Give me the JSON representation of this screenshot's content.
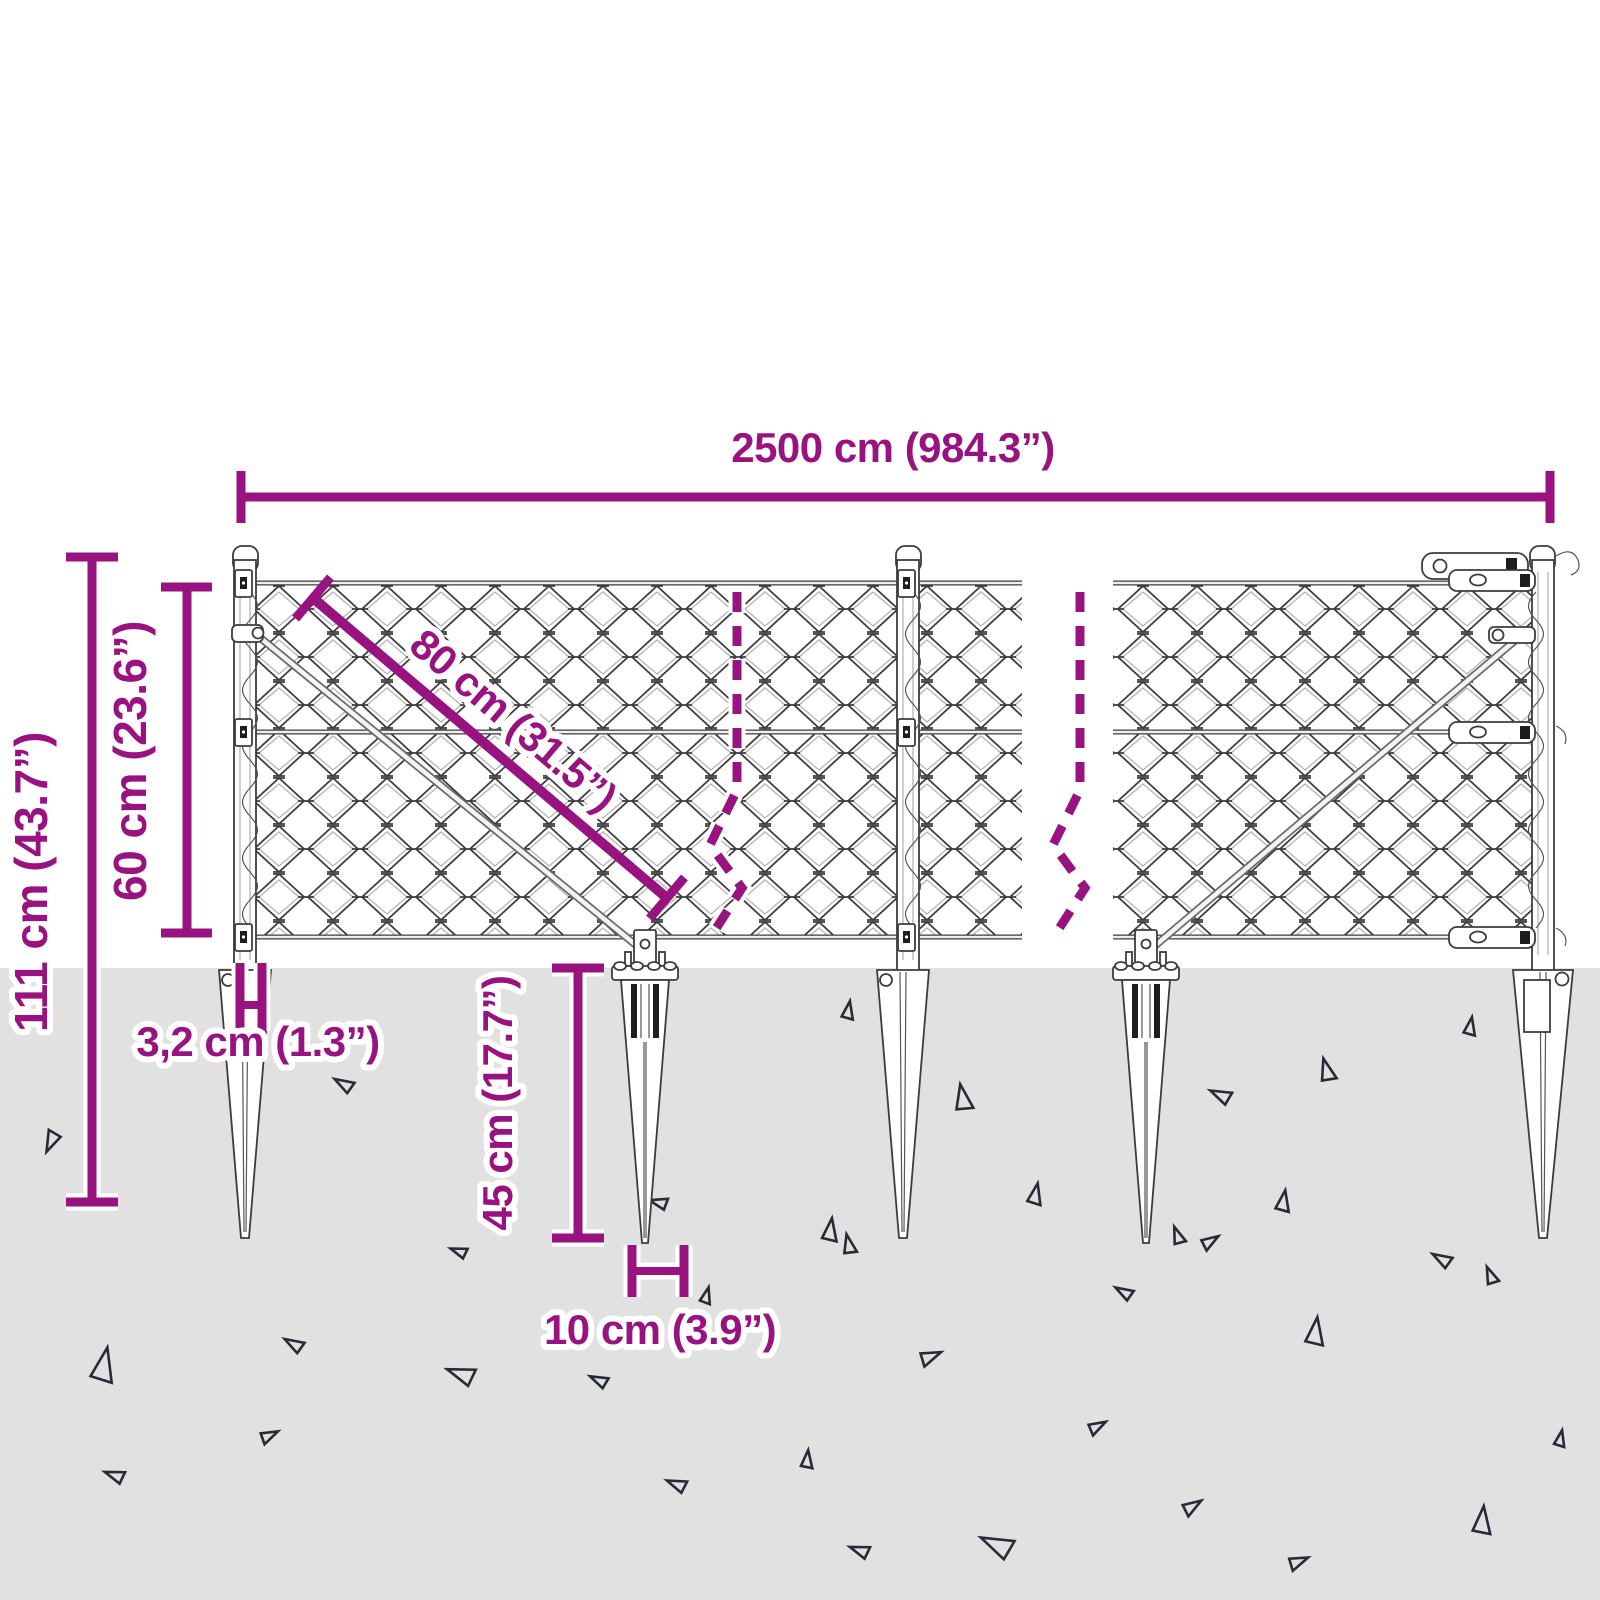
{
  "diagram": {
    "title": "chain-link fence with ground spikes — dimension drawing",
    "dimensions": {
      "total_length": "2500 cm (984.3”)",
      "total_height": "111 cm (43.7”)",
      "mesh_height": "60 cm (23.6”)",
      "panel_diagonal": "80 cm (31.5”)",
      "post_width": "3,2 cm (1.3”)",
      "spike_depth": "45 cm (17.7”)",
      "spike_width": "10 cm (3.9”)"
    },
    "colors": {
      "accent": "#98137F",
      "ground": "#E1E1E1",
      "line": "#3C3C3C"
    },
    "ground_triangles": [
      [
        52,
        1140,
        13,
        205
      ],
      [
        345,
        1085,
        12,
        300
      ],
      [
        848,
        1012,
        11,
        10
      ],
      [
        963,
        1100,
        16,
        350
      ],
      [
        1327,
        1072,
        14,
        345
      ],
      [
        1222,
        1096,
        13,
        295
      ],
      [
        1470,
        1028,
        11,
        10
      ],
      [
        660,
        1203,
        11,
        285
      ],
      [
        460,
        1252,
        10,
        290
      ],
      [
        830,
        1232,
        14,
        8
      ],
      [
        1035,
        1196,
        13,
        12
      ],
      [
        1178,
        1237,
        11,
        340
      ],
      [
        1283,
        1203,
        13,
        10
      ],
      [
        1443,
        1260,
        12,
        300
      ],
      [
        103,
        1368,
        21,
        12
      ],
      [
        295,
        1345,
        12,
        300
      ],
      [
        463,
        1375,
        17,
        290
      ],
      [
        600,
        1381,
        11,
        295
      ],
      [
        268,
        1436,
        11,
        65
      ],
      [
        116,
        1476,
        12,
        290
      ],
      [
        678,
        1485,
        12,
        292
      ],
      [
        706,
        1297,
        10,
        15
      ],
      [
        849,
        1246,
        12,
        348
      ],
      [
        1209,
        1242,
        11,
        58
      ],
      [
        1491,
        1277,
        11,
        338
      ],
      [
        1125,
        1293,
        11,
        300
      ],
      [
        929,
        1357,
        13,
        68
      ],
      [
        1315,
        1334,
        17,
        8
      ],
      [
        1096,
        1427,
        11,
        62
      ],
      [
        807,
        1461,
        11,
        6
      ],
      [
        1560,
        1440,
        10,
        12
      ],
      [
        1191,
        1507,
        12,
        58
      ],
      [
        1482,
        1523,
        17,
        6
      ],
      [
        861,
        1551,
        12,
        290
      ],
      [
        999,
        1546,
        20,
        295
      ],
      [
        1297,
        1562,
        12,
        68
      ]
    ]
  }
}
